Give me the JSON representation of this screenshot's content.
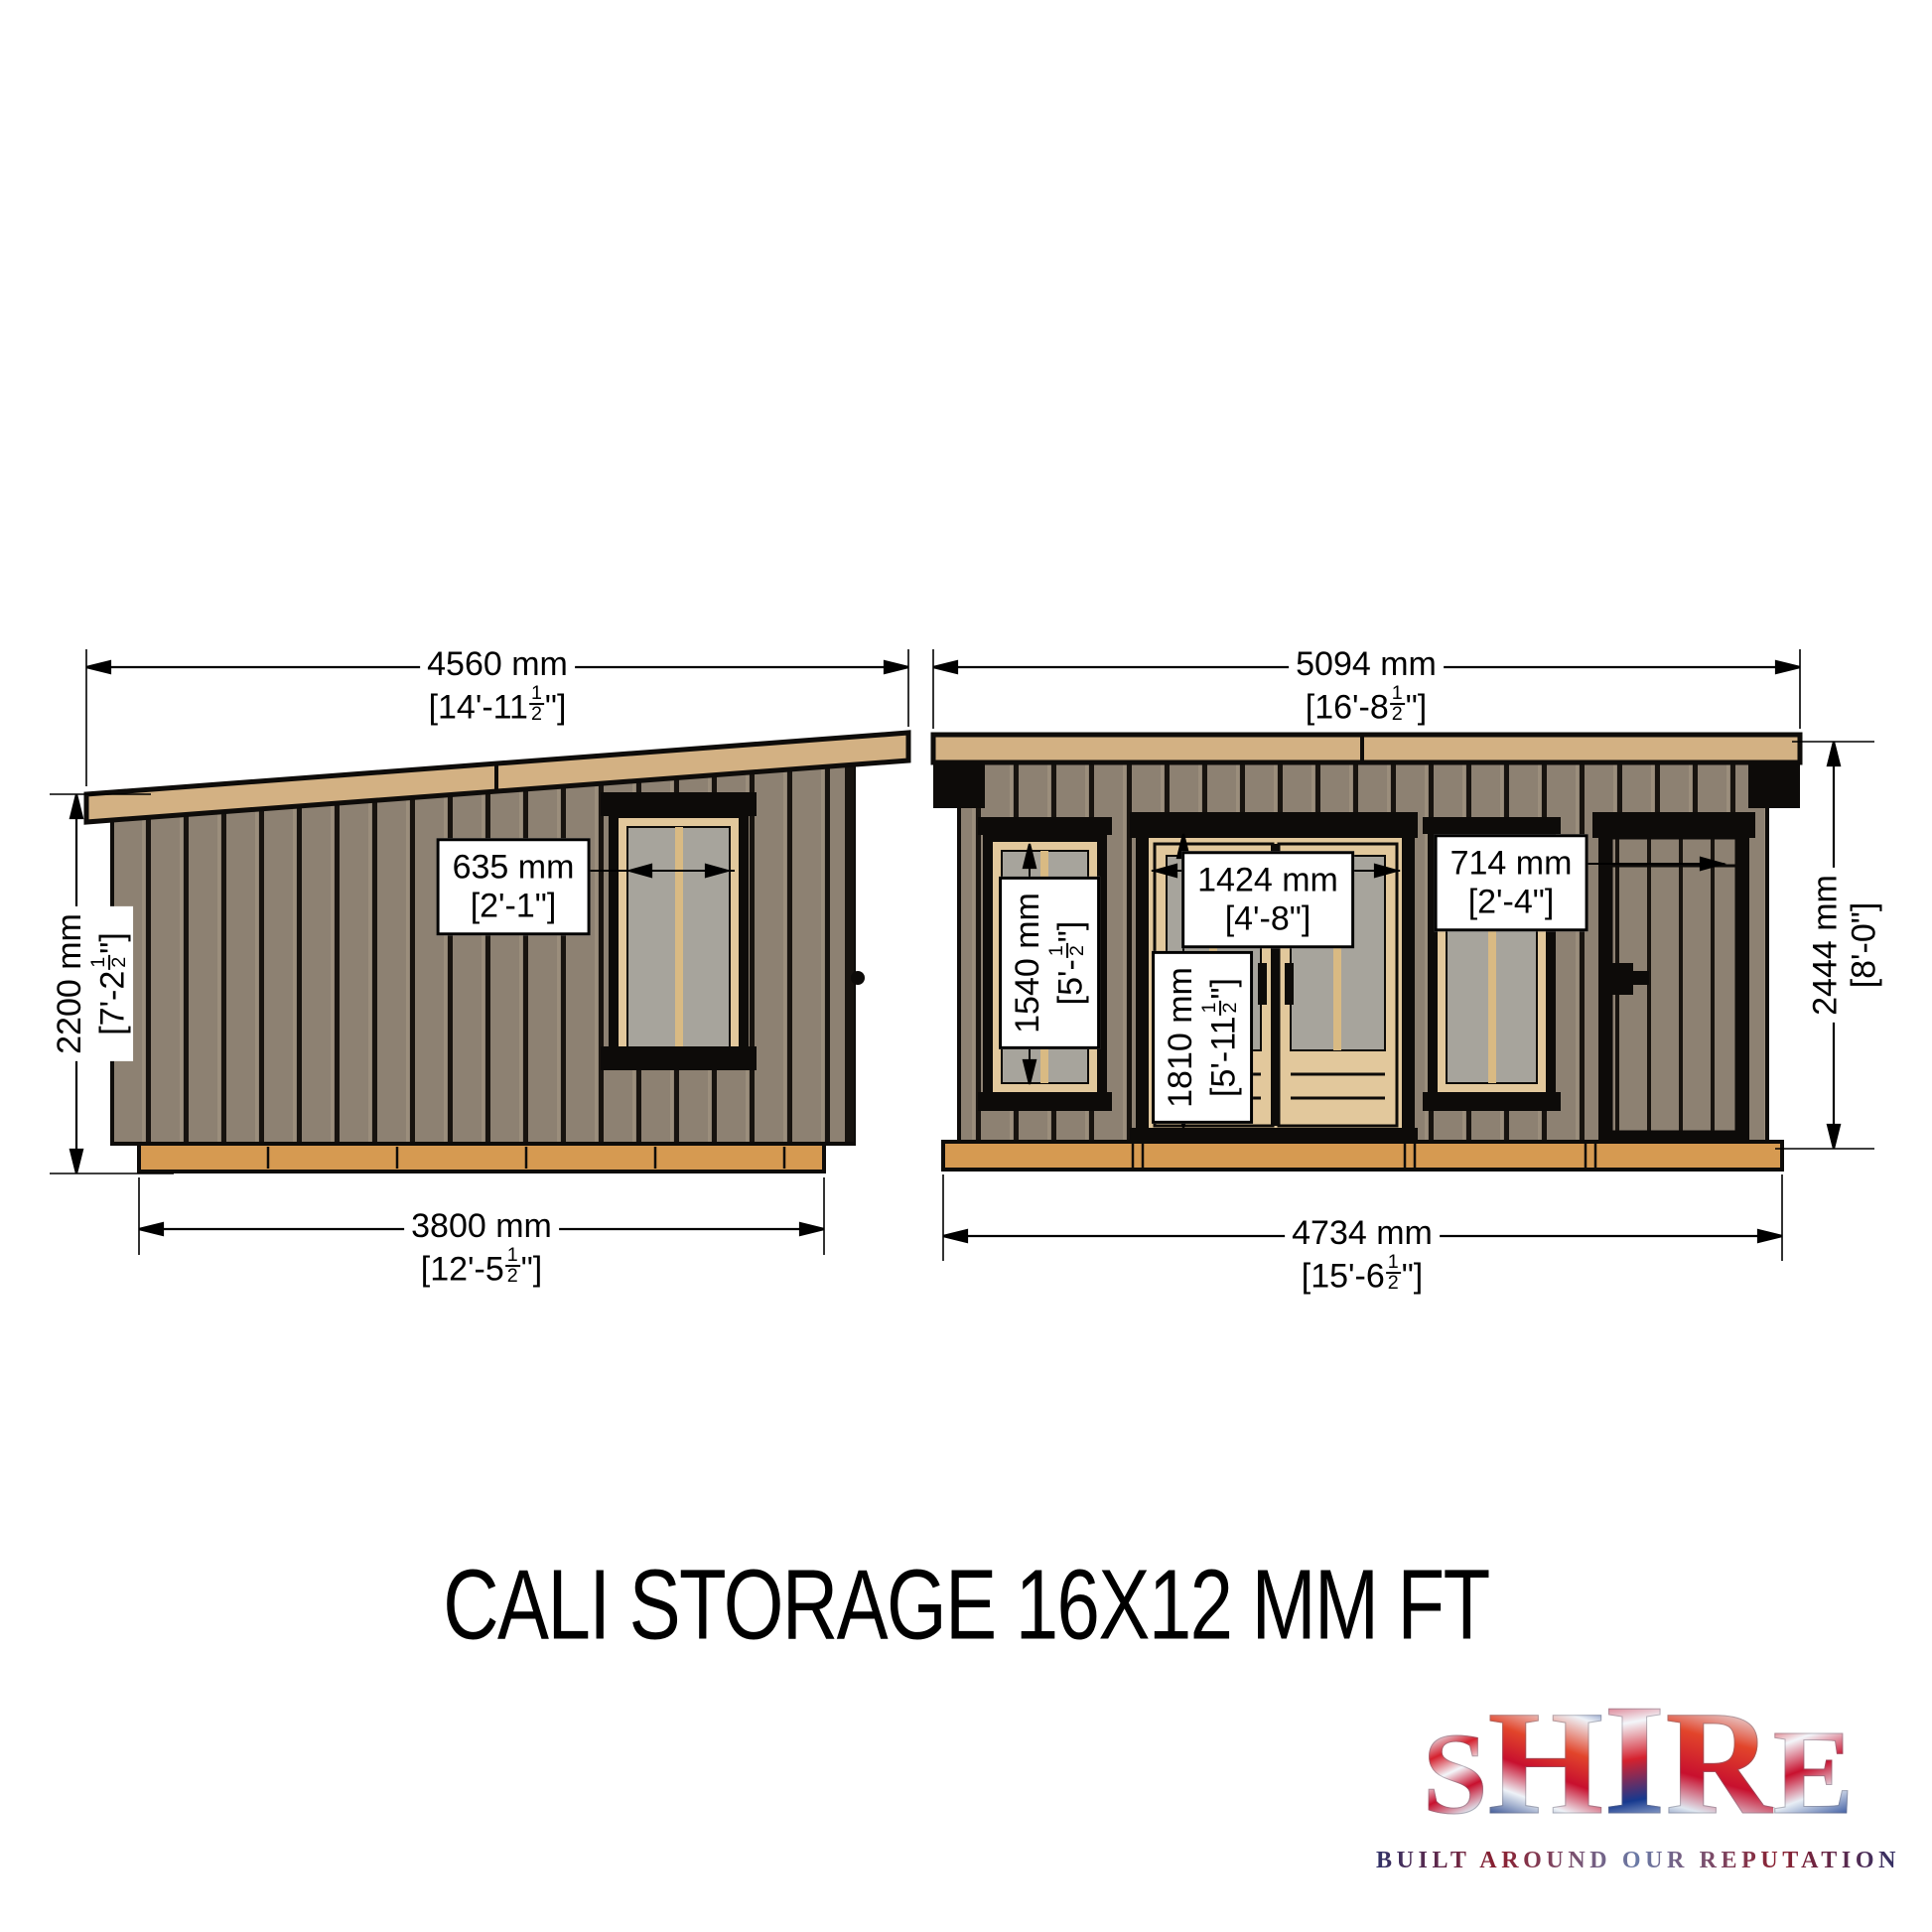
{
  "title": "CALI STORAGE 16X12 MM FT",
  "logo": {
    "letters": [
      "S",
      "H",
      "I",
      "R",
      "E"
    ],
    "tagline": "BUILT AROUND OUR REPUTATION"
  },
  "colors": {
    "wall": "#8d8172",
    "wall-light": "#9b8e7c",
    "batten": "#17130f",
    "roof": "#d3b183",
    "base": "#d69a51",
    "trim": "#e2c89c",
    "glass": "#a7a49c",
    "glassline": "#d9ba83",
    "line": "#0e0c0a"
  },
  "views": {
    "side": {
      "dims": {
        "width_top": {
          "mm": "4560 mm",
          "ft_prefix": "[14'-11",
          "frac_num": "1",
          "frac_den": "2",
          "ft_suffix": "\"]"
        },
        "height_left": {
          "mm": "2200 mm",
          "ft_prefix": "[7'-2",
          "frac_num": "1",
          "frac_den": "2",
          "ft_suffix": "\"]"
        },
        "window_width": {
          "mm": "635 mm",
          "ft_prefix": "[2'-1",
          "frac_num": "",
          "frac_den": "",
          "ft_suffix": "\"]"
        },
        "width_bottom": {
          "mm": "3800 mm",
          "ft_prefix": "[12'-5",
          "frac_num": "1",
          "frac_den": "2",
          "ft_suffix": "\"]"
        }
      }
    },
    "front": {
      "dims": {
        "width_top": {
          "mm": "5094 mm",
          "ft_prefix": "[16'-8",
          "frac_num": "1",
          "frac_den": "2",
          "ft_suffix": "\"]"
        },
        "height_right": {
          "mm": "2444 mm",
          "ft_prefix": "[8'-0",
          "frac_num": "",
          "frac_den": "",
          "ft_suffix": "\"]"
        },
        "window_height": {
          "mm": "1540 mm",
          "ft_prefix": "[5'-",
          "frac_num": "1",
          "frac_den": "2",
          "ft_suffix": "\"]"
        },
        "door_height": {
          "mm": "1810 mm",
          "ft_prefix": "[5'-11",
          "frac_num": "1",
          "frac_den": "2",
          "ft_suffix": "\"]"
        },
        "door_width": {
          "mm": "1424 mm",
          "ft_prefix": "[4'-8",
          "frac_num": "",
          "frac_den": "",
          "ft_suffix": "\"]"
        },
        "window_width": {
          "mm": "714 mm",
          "ft_prefix": "[2'-4",
          "frac_num": "",
          "frac_den": "",
          "ft_suffix": "\"]"
        },
        "width_bottom": {
          "mm": "4734 mm",
          "ft_prefix": "[15'-6",
          "frac_num": "1",
          "frac_den": "2",
          "ft_suffix": "\"]"
        }
      }
    }
  }
}
